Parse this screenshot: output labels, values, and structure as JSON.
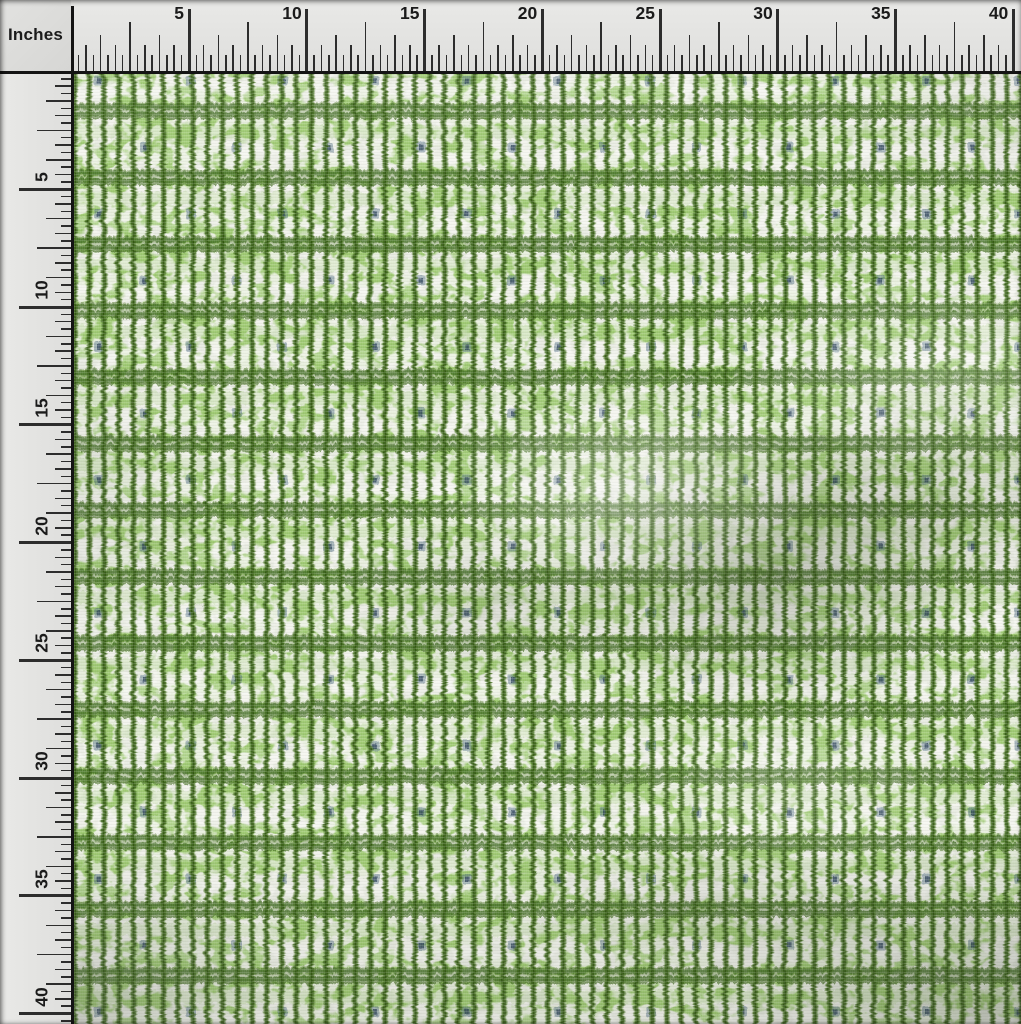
{
  "photo": {
    "subject": "Green ikat-stripe fabric swatch photographed under inch measuring rulers"
  },
  "ruler": {
    "unit_label": "Inches",
    "numbers": [
      5,
      10,
      15,
      20,
      25,
      30,
      35,
      40
    ],
    "subdivisions_per_numbered_interval": 16,
    "colors": {
      "background": "#e4e4e2",
      "tick": "#2d2d2d",
      "baseline": "#141414",
      "number_text": "#1b1b1b"
    }
  },
  "fabric": {
    "pattern_description": "vertical wavy dark-green ikat stripes, horizontal dark-green bands, light-green mottle, small blue-grey dots",
    "colors": {
      "base": "#e7eae0",
      "mottle_green": "#8cc157",
      "mottle_white": "#f4f5ef",
      "stripe_green": "#456e20",
      "stripe_core": "#2f5410",
      "band_green": "#3f6a1c",
      "band_gap_green": "#9cc96a",
      "dot_blue": "#48617c",
      "dot_core": "#243c55"
    }
  }
}
